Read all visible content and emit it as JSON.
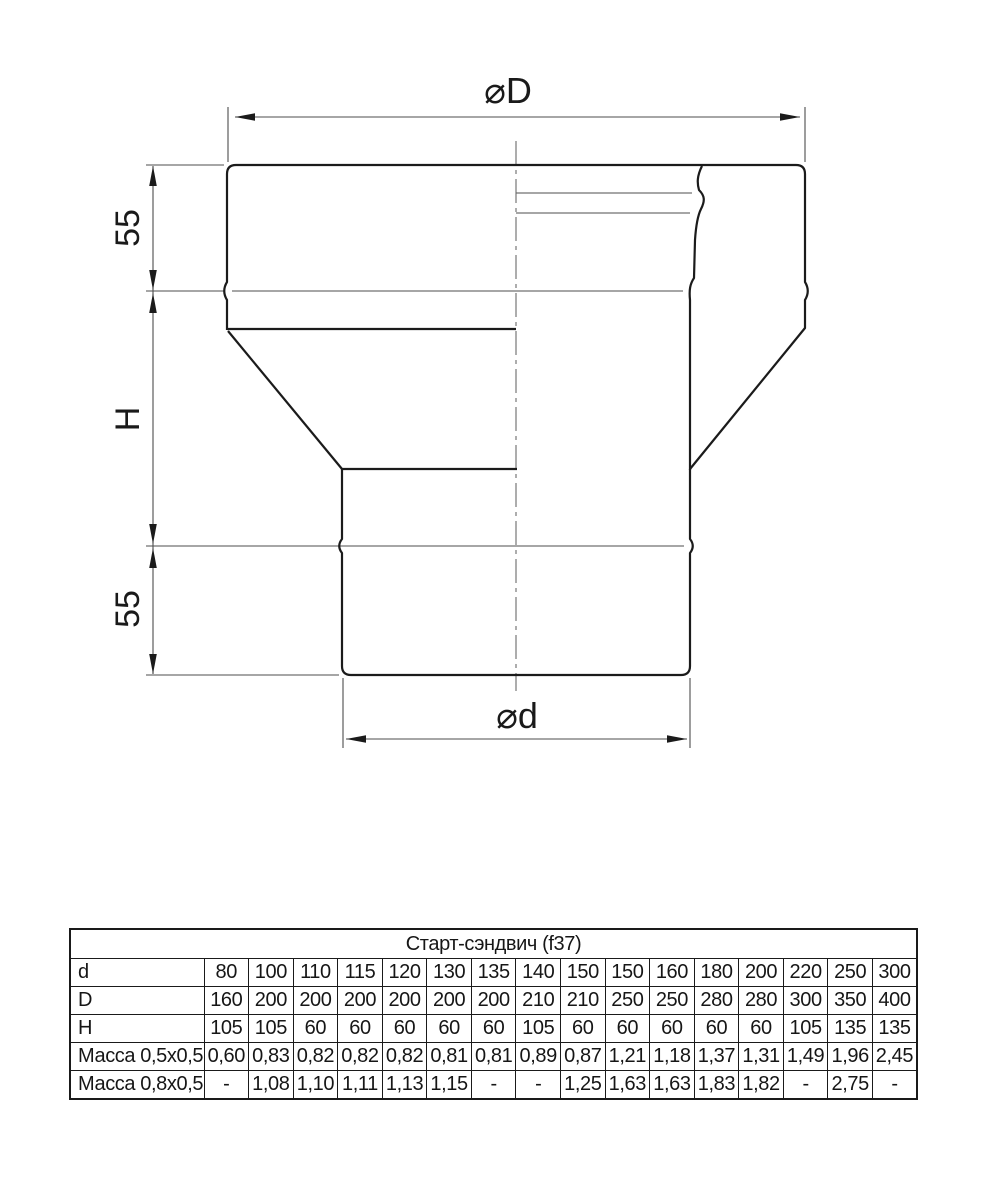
{
  "drawing": {
    "dim_top_diameter": "⌀D",
    "dim_bottom_diameter": "⌀d",
    "dim_left_top": "55",
    "dim_left_middle": "H",
    "dim_left_bottom": "55",
    "line_color": "#1b1b1b",
    "thin_line_color": "#4d4d4d",
    "centerline_color": "#6a6a6a"
  },
  "table": {
    "title": "Старт-сэндвич (f37)",
    "rows": [
      {
        "label": "d",
        "values": [
          "80",
          "100",
          "110",
          "115",
          "120",
          "130",
          "135",
          "140",
          "150",
          "150",
          "160",
          "180",
          "200",
          "220",
          "250",
          "300"
        ]
      },
      {
        "label": "D",
        "values": [
          "160",
          "200",
          "200",
          "200",
          "200",
          "200",
          "200",
          "210",
          "210",
          "250",
          "250",
          "280",
          "280",
          "300",
          "350",
          "400"
        ]
      },
      {
        "label": "H",
        "values": [
          "105",
          "105",
          "60",
          "60",
          "60",
          "60",
          "60",
          "105",
          "60",
          "60",
          "60",
          "60",
          "60",
          "105",
          "135",
          "135"
        ]
      },
      {
        "label": "Масса 0,5x0,5",
        "values": [
          "0,60",
          "0,83",
          "0,82",
          "0,82",
          "0,82",
          "0,81",
          "0,81",
          "0,89",
          "0,87",
          "1,21",
          "1,18",
          "1,37",
          "1,31",
          "1,49",
          "1,96",
          "2,45"
        ]
      },
      {
        "label": "Масса 0,8x0,5",
        "values": [
          "-",
          "1,08",
          "1,10",
          "1,11",
          "1,13",
          "1,15",
          "-",
          "-",
          "1,25",
          "1,63",
          "1,63",
          "1,83",
          "1,82",
          "-",
          "2,75",
          "-"
        ]
      }
    ]
  }
}
